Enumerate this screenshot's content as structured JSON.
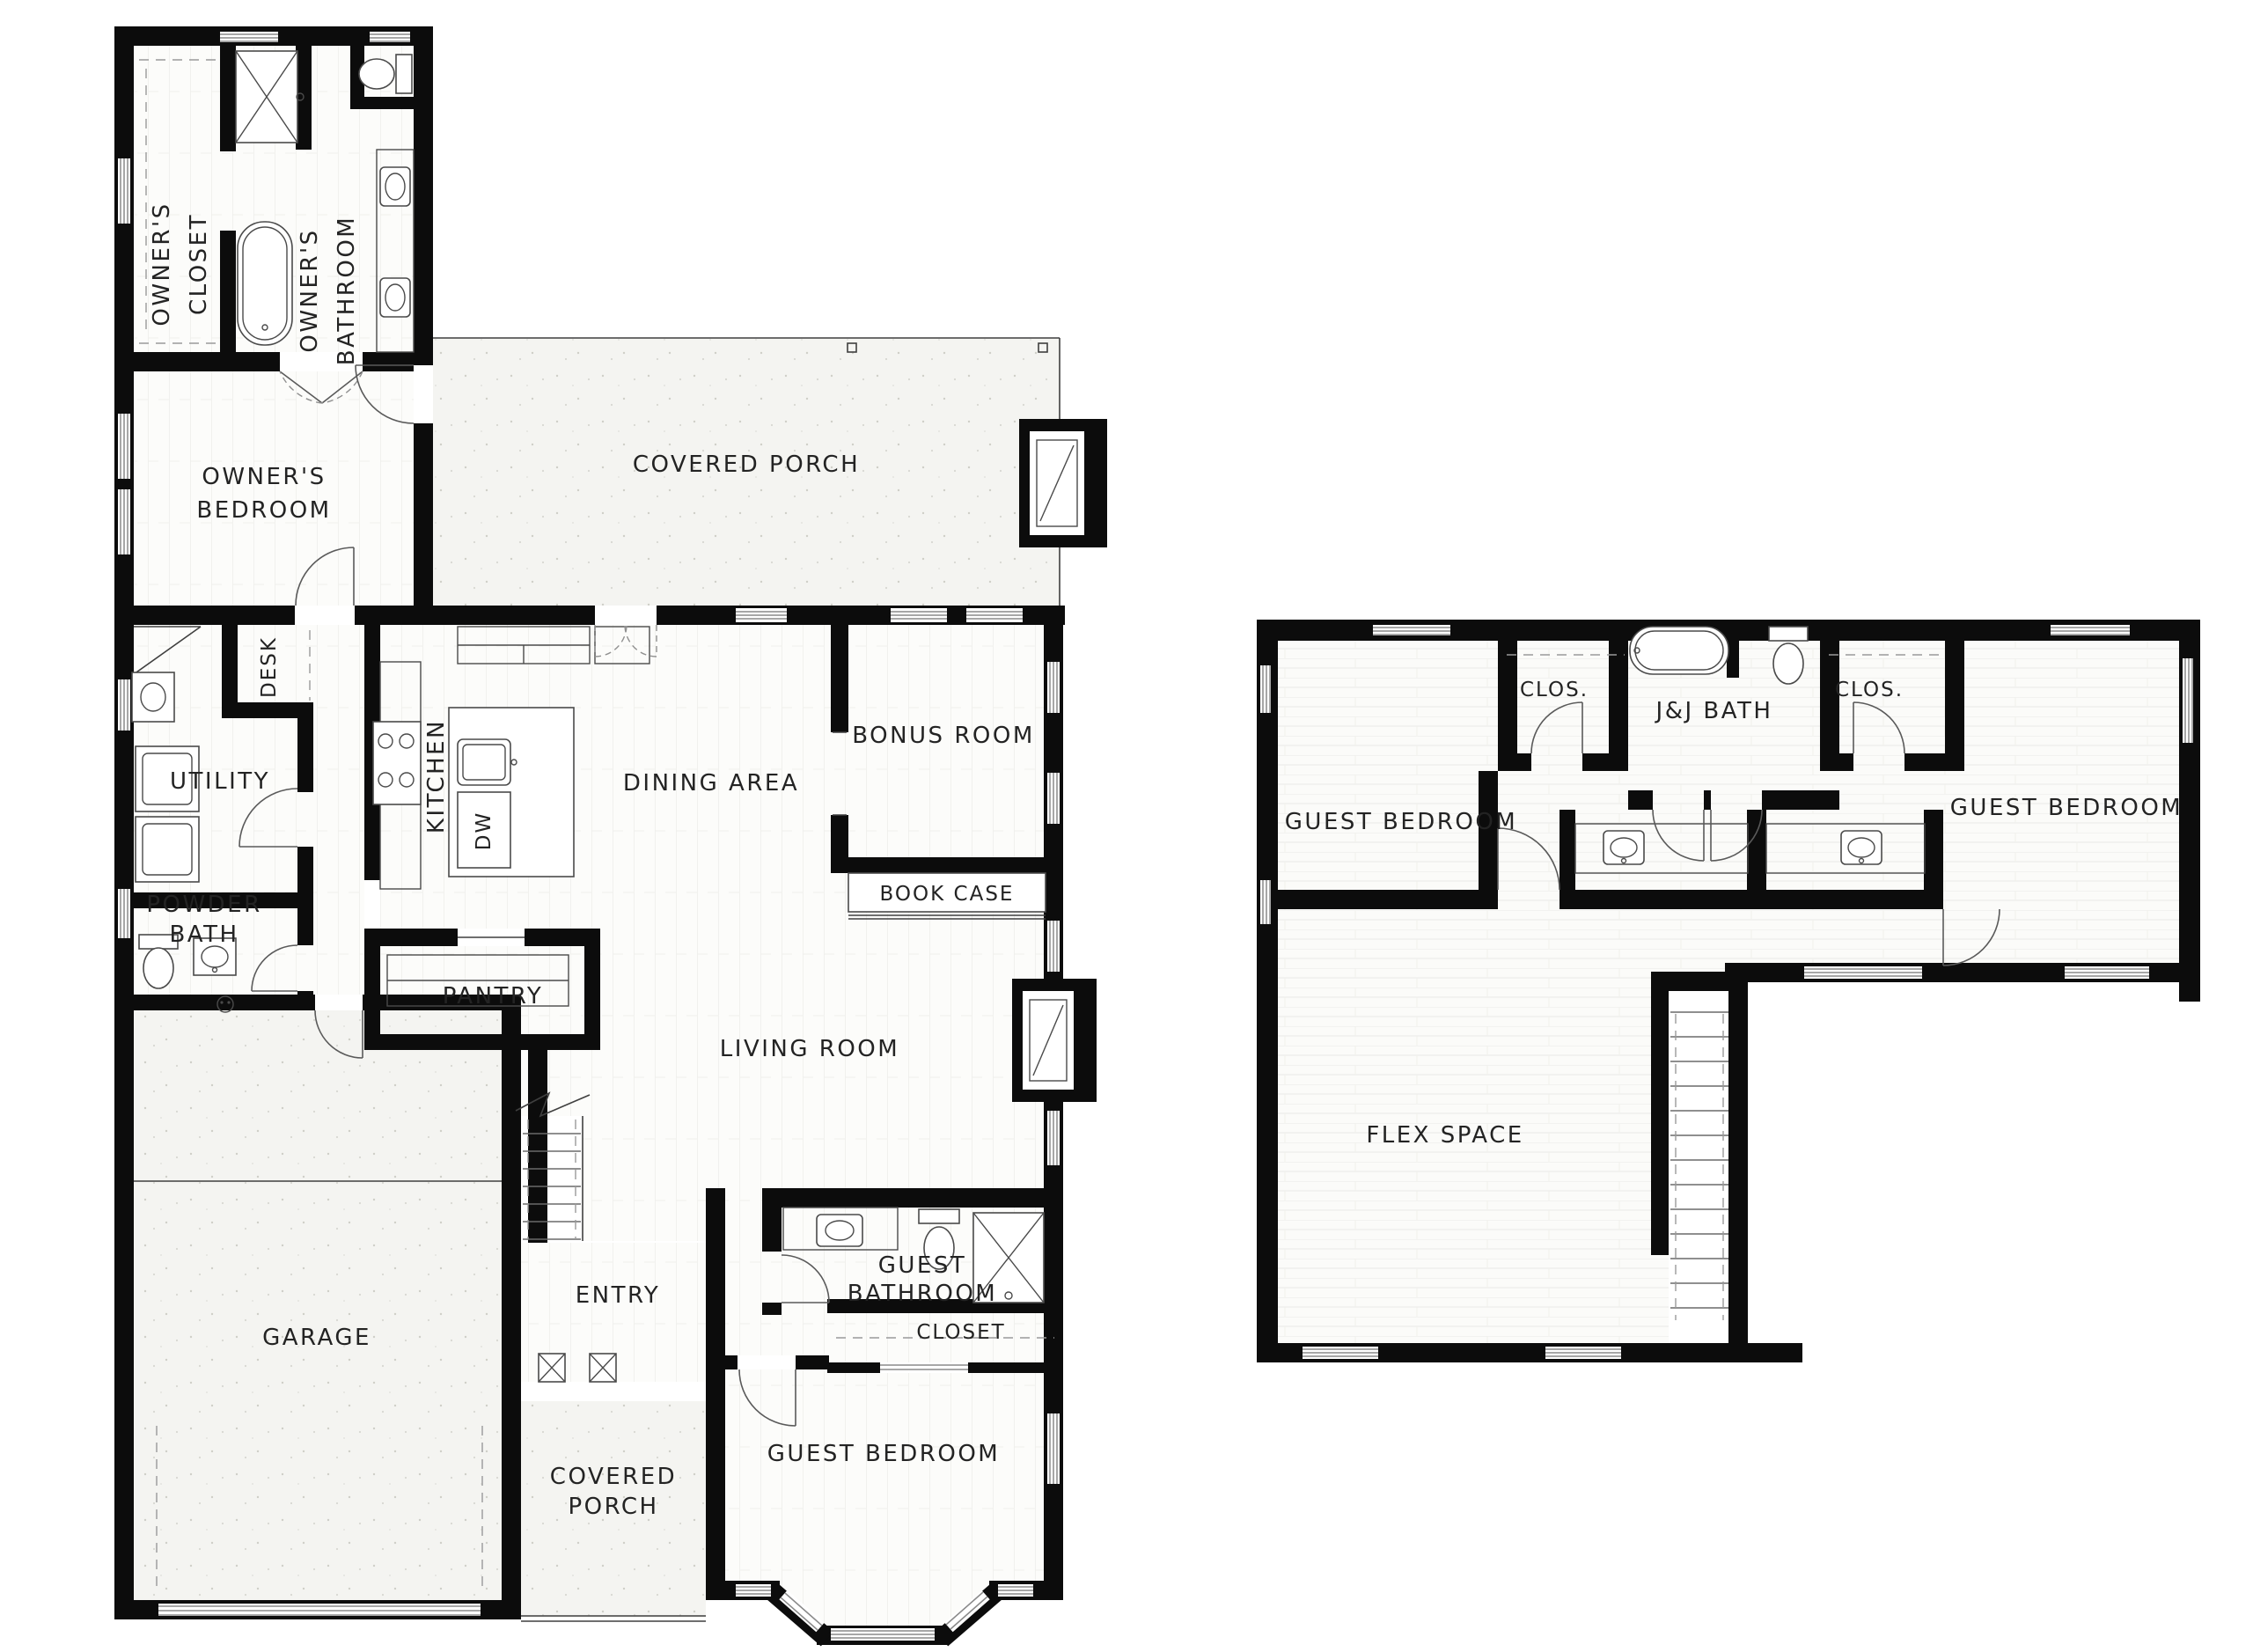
{
  "document": {
    "type": "architectural-floor-plan",
    "background": "#ffffff"
  },
  "colors": {
    "wall": "#0c0c0c",
    "label": "#232323",
    "wood_floor": "#fcfcfa",
    "plank_line": "#e6e6e3",
    "concrete": "#f4f4f1",
    "speckle": "#cfcfc8"
  },
  "floor1": {
    "labels": {
      "owners_closet": [
        "OWNER'S",
        "CLOSET"
      ],
      "owners_bathroom": [
        "OWNER'S",
        "BATHROOM"
      ],
      "owners_bedroom": [
        "OWNER'S",
        "BEDROOM"
      ],
      "covered_porch": [
        "COVERED PORCH"
      ],
      "desk": [
        "DESK"
      ],
      "utility": [
        "UTILITY"
      ],
      "kitchen": [
        "KITCHEN"
      ],
      "dw": [
        "DW"
      ],
      "dining_area": [
        "DINING AREA"
      ],
      "bonus_room": [
        "BONUS ROOM"
      ],
      "book_case": [
        "BOOK CASE"
      ],
      "powder_bath": [
        "POWDER",
        "BATH"
      ],
      "pantry": [
        "PANTRY"
      ],
      "living_room": [
        "LIVING ROOM"
      ],
      "garage": [
        "GARAGE"
      ],
      "entry": [
        "ENTRY"
      ],
      "covered_porch_front": [
        "COVERED",
        "PORCH"
      ],
      "guest_bathroom": [
        "GUEST",
        "BATHROOM"
      ],
      "closet": [
        "CLOSET"
      ],
      "guest_bedroom": [
        "GUEST BEDROOM"
      ]
    }
  },
  "floor2": {
    "labels": {
      "guest_bedroom_left": [
        "GUEST BEDROOM"
      ],
      "clos_left": [
        "CLOS."
      ],
      "jj_bath": [
        "J&J BATH"
      ],
      "clos_right": [
        "CLOS."
      ],
      "guest_bedroom_right": [
        "GUEST BEDROOM"
      ],
      "flex_space": [
        "FLEX SPACE"
      ]
    }
  }
}
